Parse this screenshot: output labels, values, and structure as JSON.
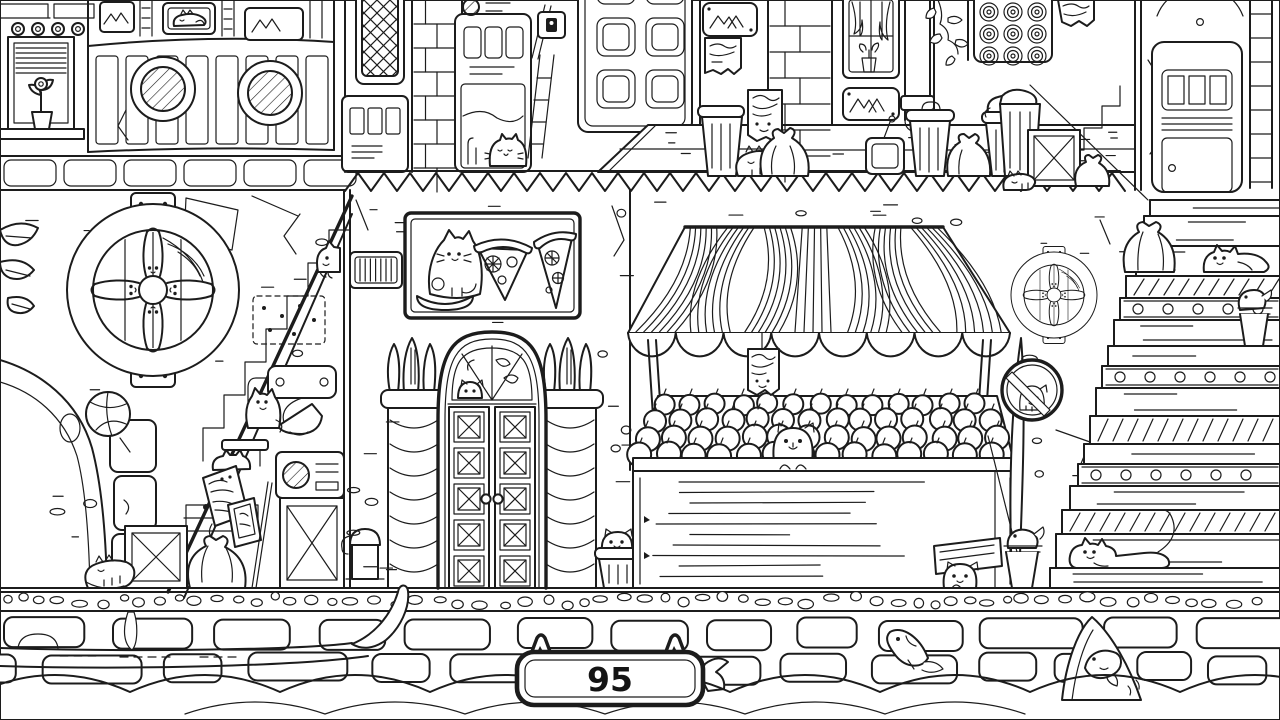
{
  "hud": {
    "counter_value": "95",
    "badge_icon": "cat-ears-counter-badge"
  },
  "palette": {
    "line": "#1c1c1c",
    "background": "#ffffff"
  },
  "scene": {
    "description": "black-and-white line-art hidden-object street scene with cats",
    "cat_icons": [
      "cat-in-picture-frame",
      "cat-in-vending-machine",
      "cat-on-trash-can",
      "cat-sleeping-by-trash",
      "cat-by-crate-right",
      "cat-at-stairs-top",
      "cat-on-left-stairs",
      "cat-with-newspaper",
      "cat-sleeping-bottom-left",
      "cat-on-pizza-sign",
      "cat-in-transom-window",
      "cat-in-trash-can-center",
      "cat-in-apple-bin",
      "cat-behind-plank-sign",
      "cat-in-no-cats-sign",
      "cat-on-upper-step",
      "cat-stretched-on-step",
      "wheel-cats-left",
      "wheel-cats-right"
    ],
    "fish_icons": [
      "fish-jumping",
      "fish-in-hammock",
      "fish-by-counter",
      "fish-in-bucket-stall",
      "fish-in-cup-stairs"
    ],
    "landmark_icons": [
      "market-stall-awning",
      "apple-bin",
      "pizza-sign",
      "arched-door",
      "round-vent-wheel",
      "no-cats-sign",
      "grand-staircase",
      "left-staircase",
      "gondola",
      "canal-water",
      "cobblestone-quay",
      "window-with-blinds",
      "lattice-window",
      "vending-machine",
      "panel-door",
      "trash-cans",
      "basketball",
      "crates"
    ]
  }
}
